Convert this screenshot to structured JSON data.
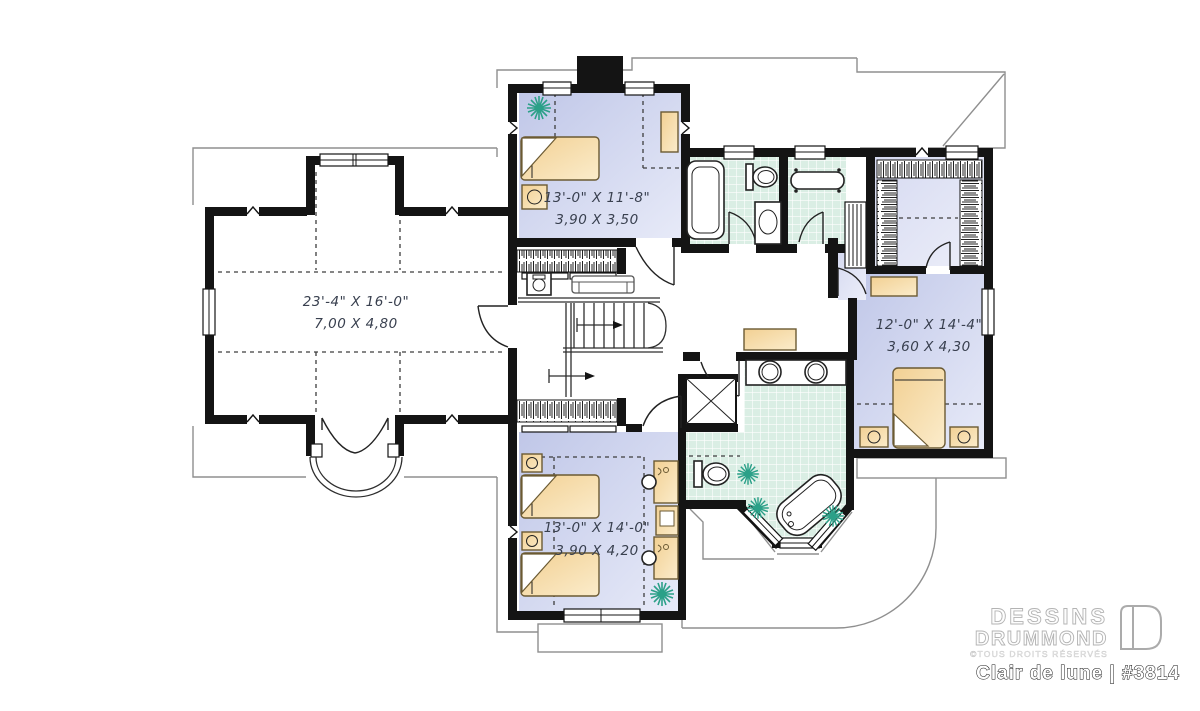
{
  "plan": {
    "brand": {
      "line1": "DESSINS",
      "line2": "DRUMMOND",
      "copyright": "©TOUS DROITS RÉSERVÉS",
      "title": "Clair de lune | #3814"
    },
    "rooms": {
      "bonus": {
        "imperial": "23'-4\" X 16'-0\"",
        "metric": "7,00 X 4,80"
      },
      "bedroom2": {
        "imperial": "13'-0\" X 11'-8\"",
        "metric": "3,90 X 3,50"
      },
      "master": {
        "imperial": "12'-0\" X 14'-4\"",
        "metric": "3,60 X 4,30"
      },
      "bedroom3": {
        "imperial": "13'-0\" X 14'-0\"",
        "metric": "3,90 X 4,20"
      }
    },
    "colors": {
      "wall": "#141414",
      "bedroom_floor": "#c5cbe9",
      "tile_floor": "#daeee4",
      "furniture": "#f2d093",
      "plant": "#2ba088"
    }
  }
}
